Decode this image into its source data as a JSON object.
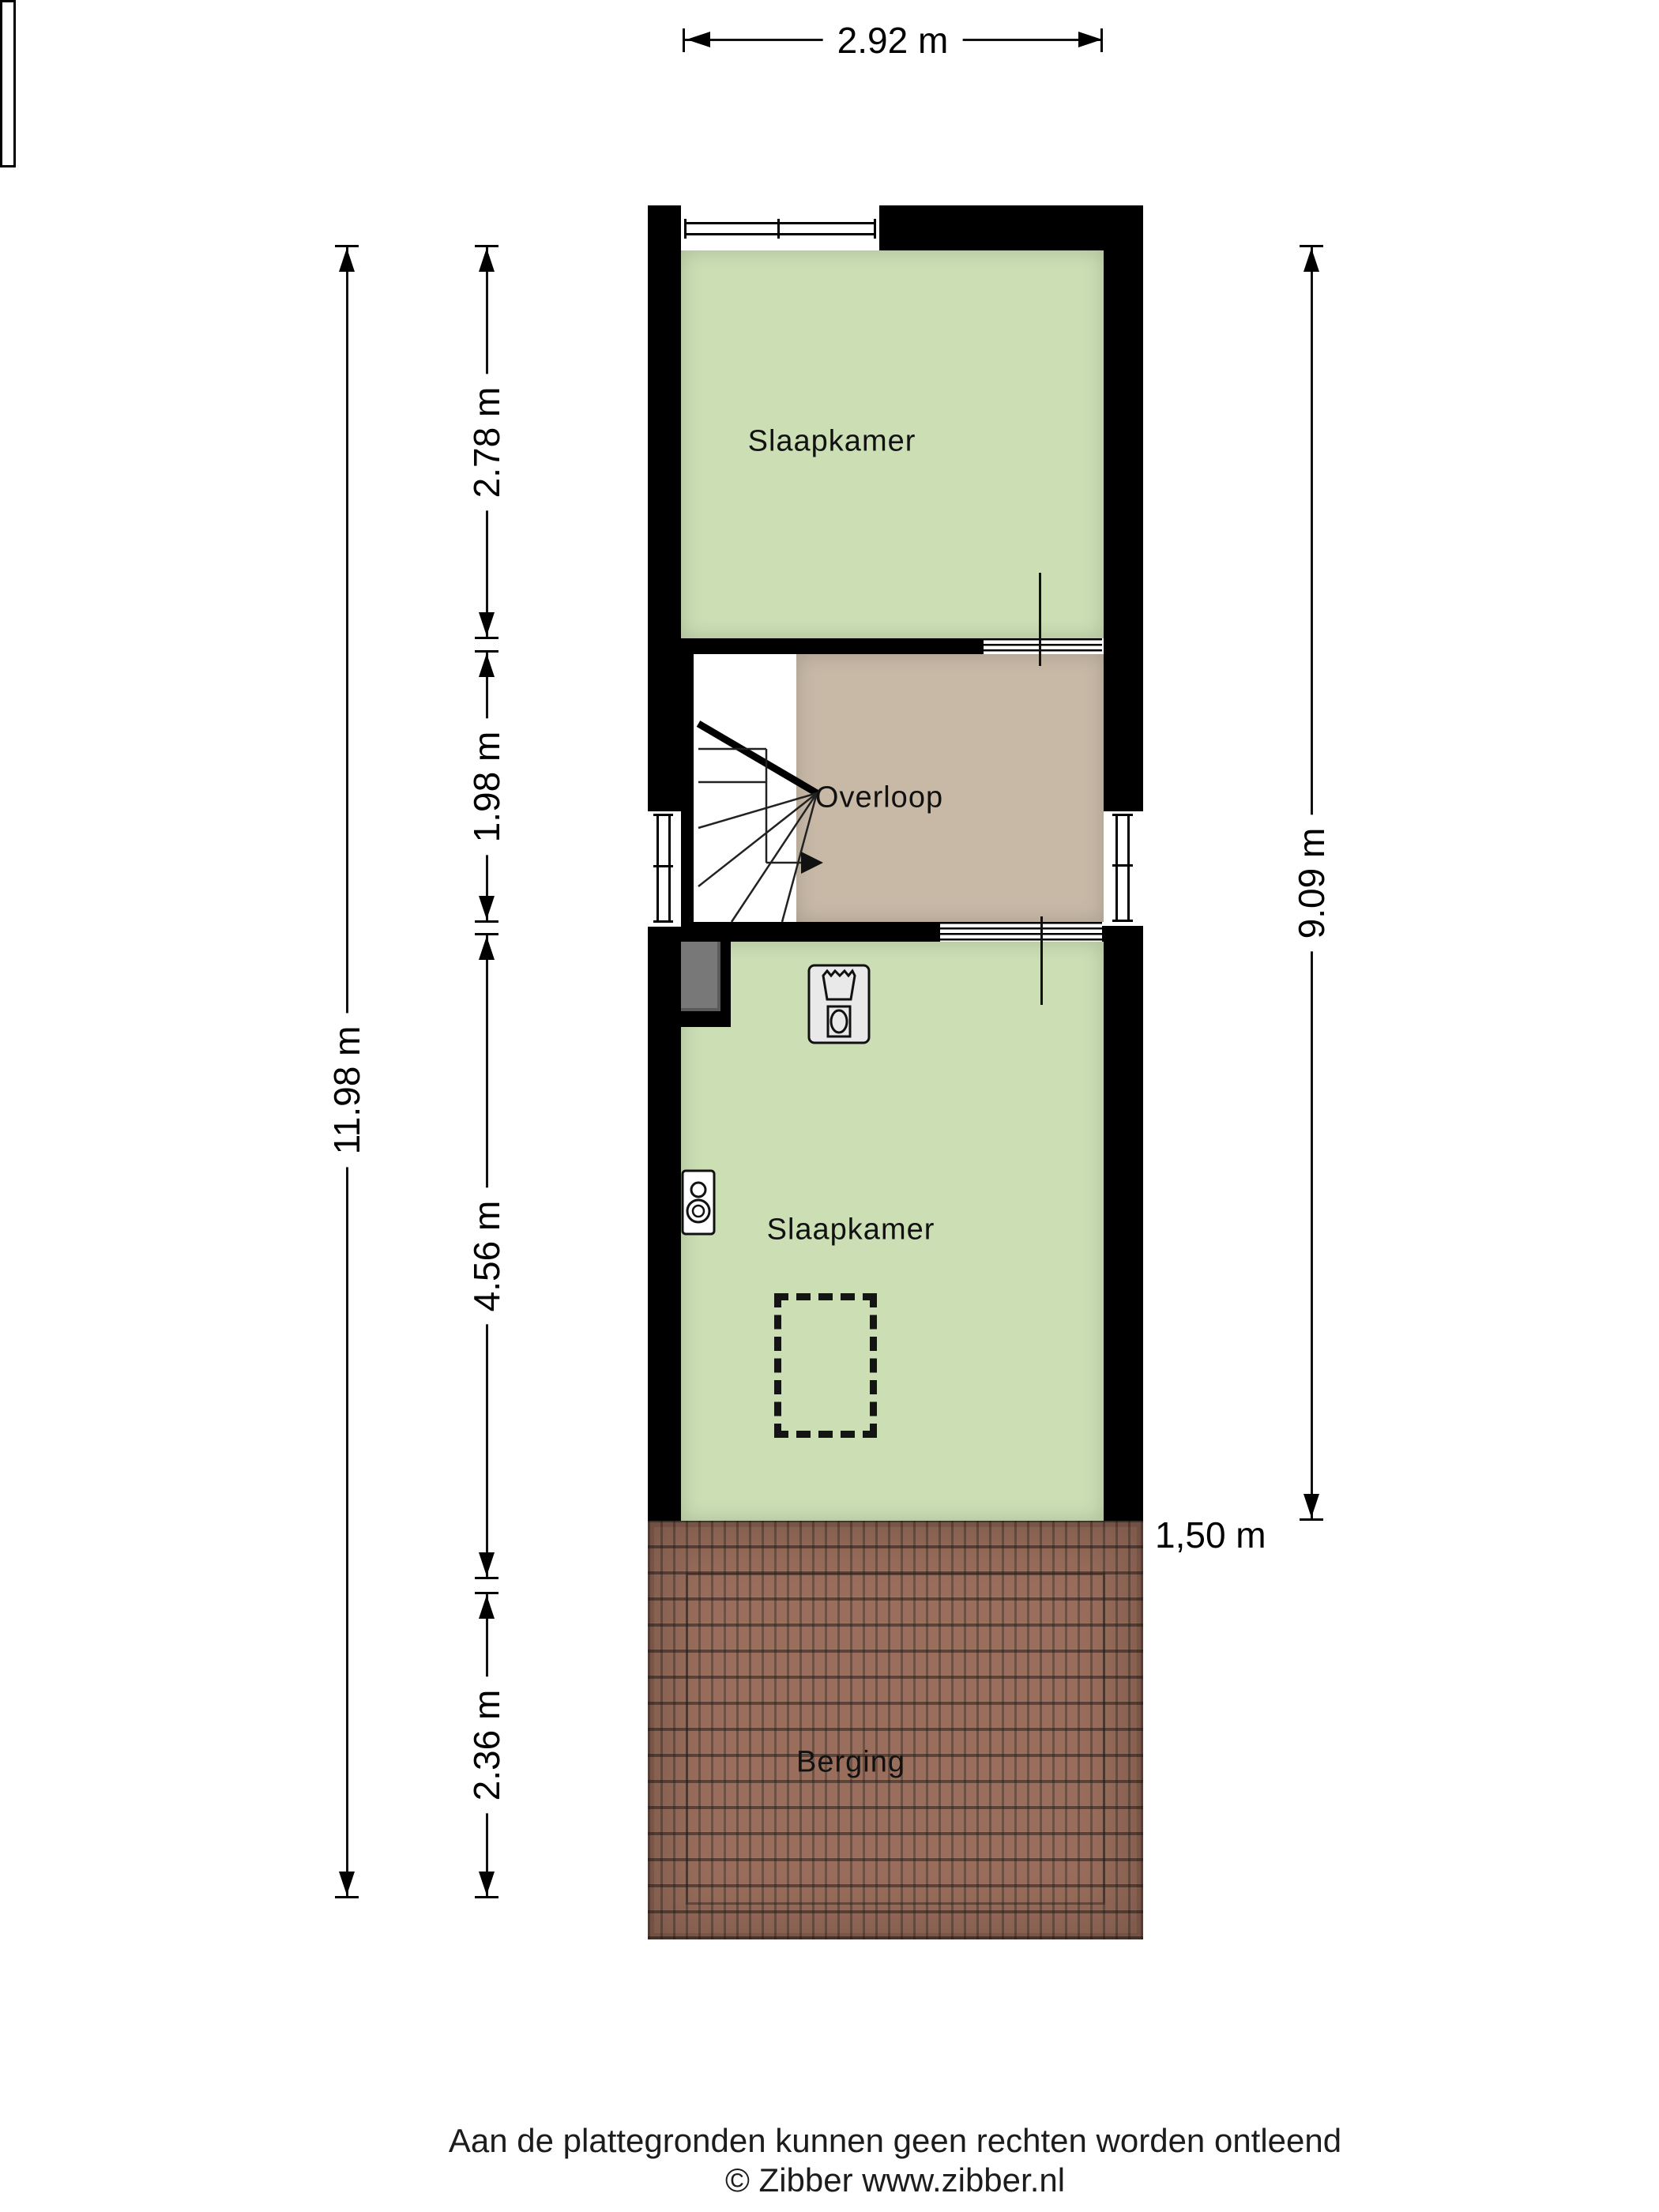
{
  "plan": {
    "rooms": [
      {
        "label": "Slaapkamer"
      },
      {
        "label": "Overloop"
      },
      {
        "label": "Slaapkamer"
      },
      {
        "label": "Berging"
      }
    ],
    "dimensions": {
      "width_top": "2.92 m",
      "height_total_left": "11.98 m",
      "left_segments": [
        "2.78 m",
        "1.98 m",
        "4.56 m",
        "2.36 m"
      ],
      "height_right": "9.09 m",
      "roof_edge": "1,50 m"
    },
    "icons": {
      "washer": "washing-machine-icon",
      "boiler": "boiler-icon",
      "stairs": "stairs-winder-icon",
      "stairs_direction": "direction-arrow-icon",
      "roof_window": "roof-window-dashed-outline",
      "duct": "chimney-duct"
    },
    "colors": {
      "wall": "#000000",
      "bedroom_fill": "#cbdeb4",
      "hall_fill": "#c8b9a7",
      "roof_tile": "#9a6e5c",
      "duct_fill": "#787878"
    }
  },
  "footer": {
    "disclaimer": "Aan de plattegronden kunnen geen rechten worden ontleend",
    "credit": "© Zibber www.zibber.nl"
  }
}
